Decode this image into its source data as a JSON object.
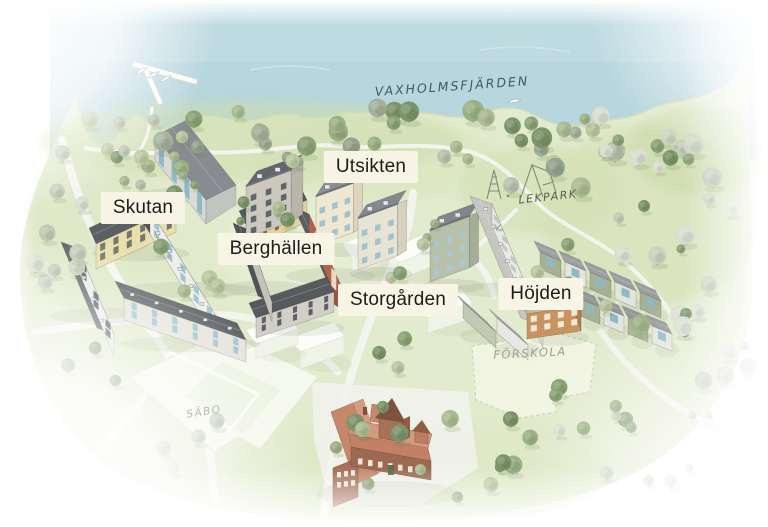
{
  "map": {
    "water_label": "VAXHOLMSFJÄRDEN",
    "districts": {
      "skutan": "Skutan",
      "berghallen": "Berghällen",
      "utsikten": "Utsikten",
      "storgarden": "Storgården",
      "hojden": "Höjden"
    },
    "places": {
      "lekpark": "LEKPARK",
      "forskola": "FÖRSKOLA",
      "sabo": "SÄBO"
    },
    "colors": {
      "water": "#b7d6de",
      "land": "#e3ebce",
      "label_background": "#f8f5e6",
      "label_text": "#1c1c1a",
      "roof_dark": "#565a5e",
      "facade_yellow": "#e9dfac",
      "facade_red": "#b2614b",
      "facade_sage": "#a6b194",
      "window_blue": "#9fc4d0",
      "school_red": "#c08163",
      "ghost_white": "#f5f8ec"
    }
  }
}
